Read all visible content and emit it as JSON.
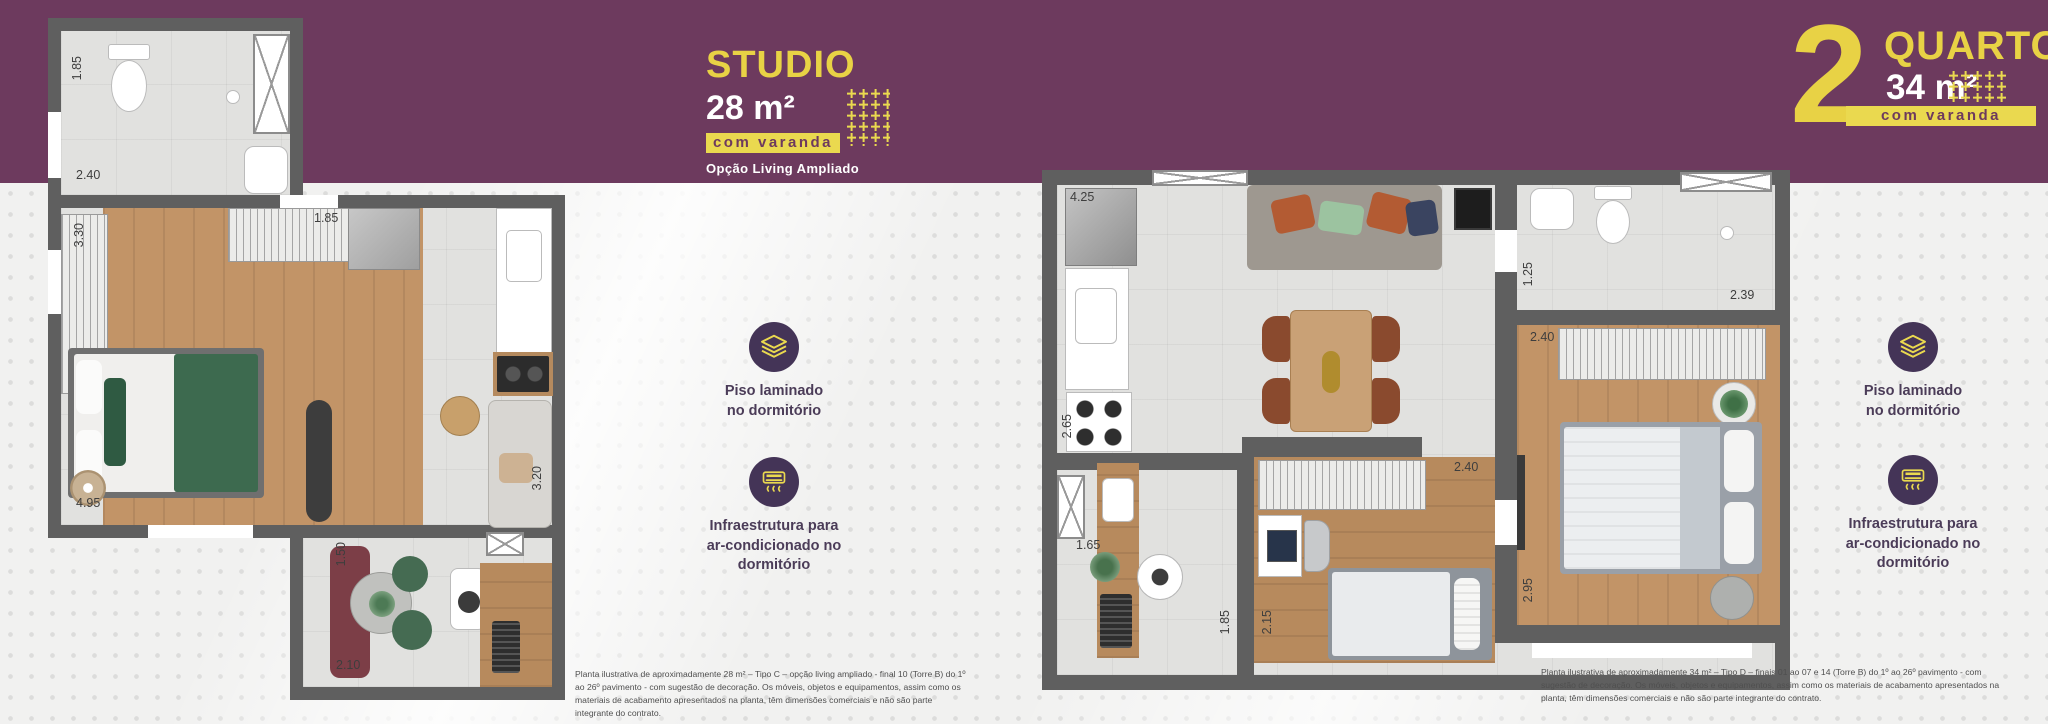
{
  "colors": {
    "purple": "#6d3a5e",
    "yellow": "#ead94f",
    "wall_gray": "#5f5f5f",
    "icon_circle": "#443457"
  },
  "studio_header": {
    "title": "STUDIO",
    "area": "28 m²",
    "badge": "com varanda",
    "subtitle": "Opção Living Ampliado"
  },
  "quartos_header": {
    "number": "2",
    "title": "QUARTOS",
    "area": "34 m²",
    "badge": "com varanda"
  },
  "amenities": {
    "floor": {
      "icon": "laminate-floor-icon",
      "label": "Piso laminado\nno dormitório"
    },
    "ac": {
      "icon": "air-conditioner-icon",
      "label": "Infraestrutura para\nar-condicionado no\ndormitório"
    }
  },
  "studio_plan": {
    "dims": {
      "bath_width": "1.85",
      "bath_depth": "2.40",
      "bedroom_width": "3.30",
      "room_length": "4.95",
      "kitchen_width": "1.85",
      "living_length": "3.20",
      "balcony_width": "1.50",
      "balcony_length": "2.10"
    },
    "disclaimer": "Planta ilustrativa de aproximadamente 28 m² – Tipo C – opção living ampliado - final 10 (Torre B) do 1º ao 26º pavimento - com sugestão de decoração. Os móveis, objetos e equipamentos, assim como os materiais de acabamento apresentados na planta, têm dimensões comerciais e não são parte integrante do contrato."
  },
  "quartos_plan": {
    "dims": {
      "kitchen_run": "4.25",
      "stove_run": "2.65",
      "hall_width": "1.25",
      "bath_width": "2.39",
      "bedroom1_width": "2.40",
      "bedroom1_length": "2.95",
      "bedroom2_width": "2.40",
      "bedroom2_length": "2.15",
      "service_width": "1.65",
      "service_length": "1.85"
    },
    "disclaimer": "Planta ilustrativa de aproximadamente 34 m² – Tipo D – finais 01 ao 07 e 14 (Torre B) do 1º ao 26º pavimento - com sugestão de decoração. Os móveis, objetos e equipamentos, assim como os materiais de acabamento apresentados na planta, têm dimensões comerciais e não são parte integrante do contrato."
  }
}
